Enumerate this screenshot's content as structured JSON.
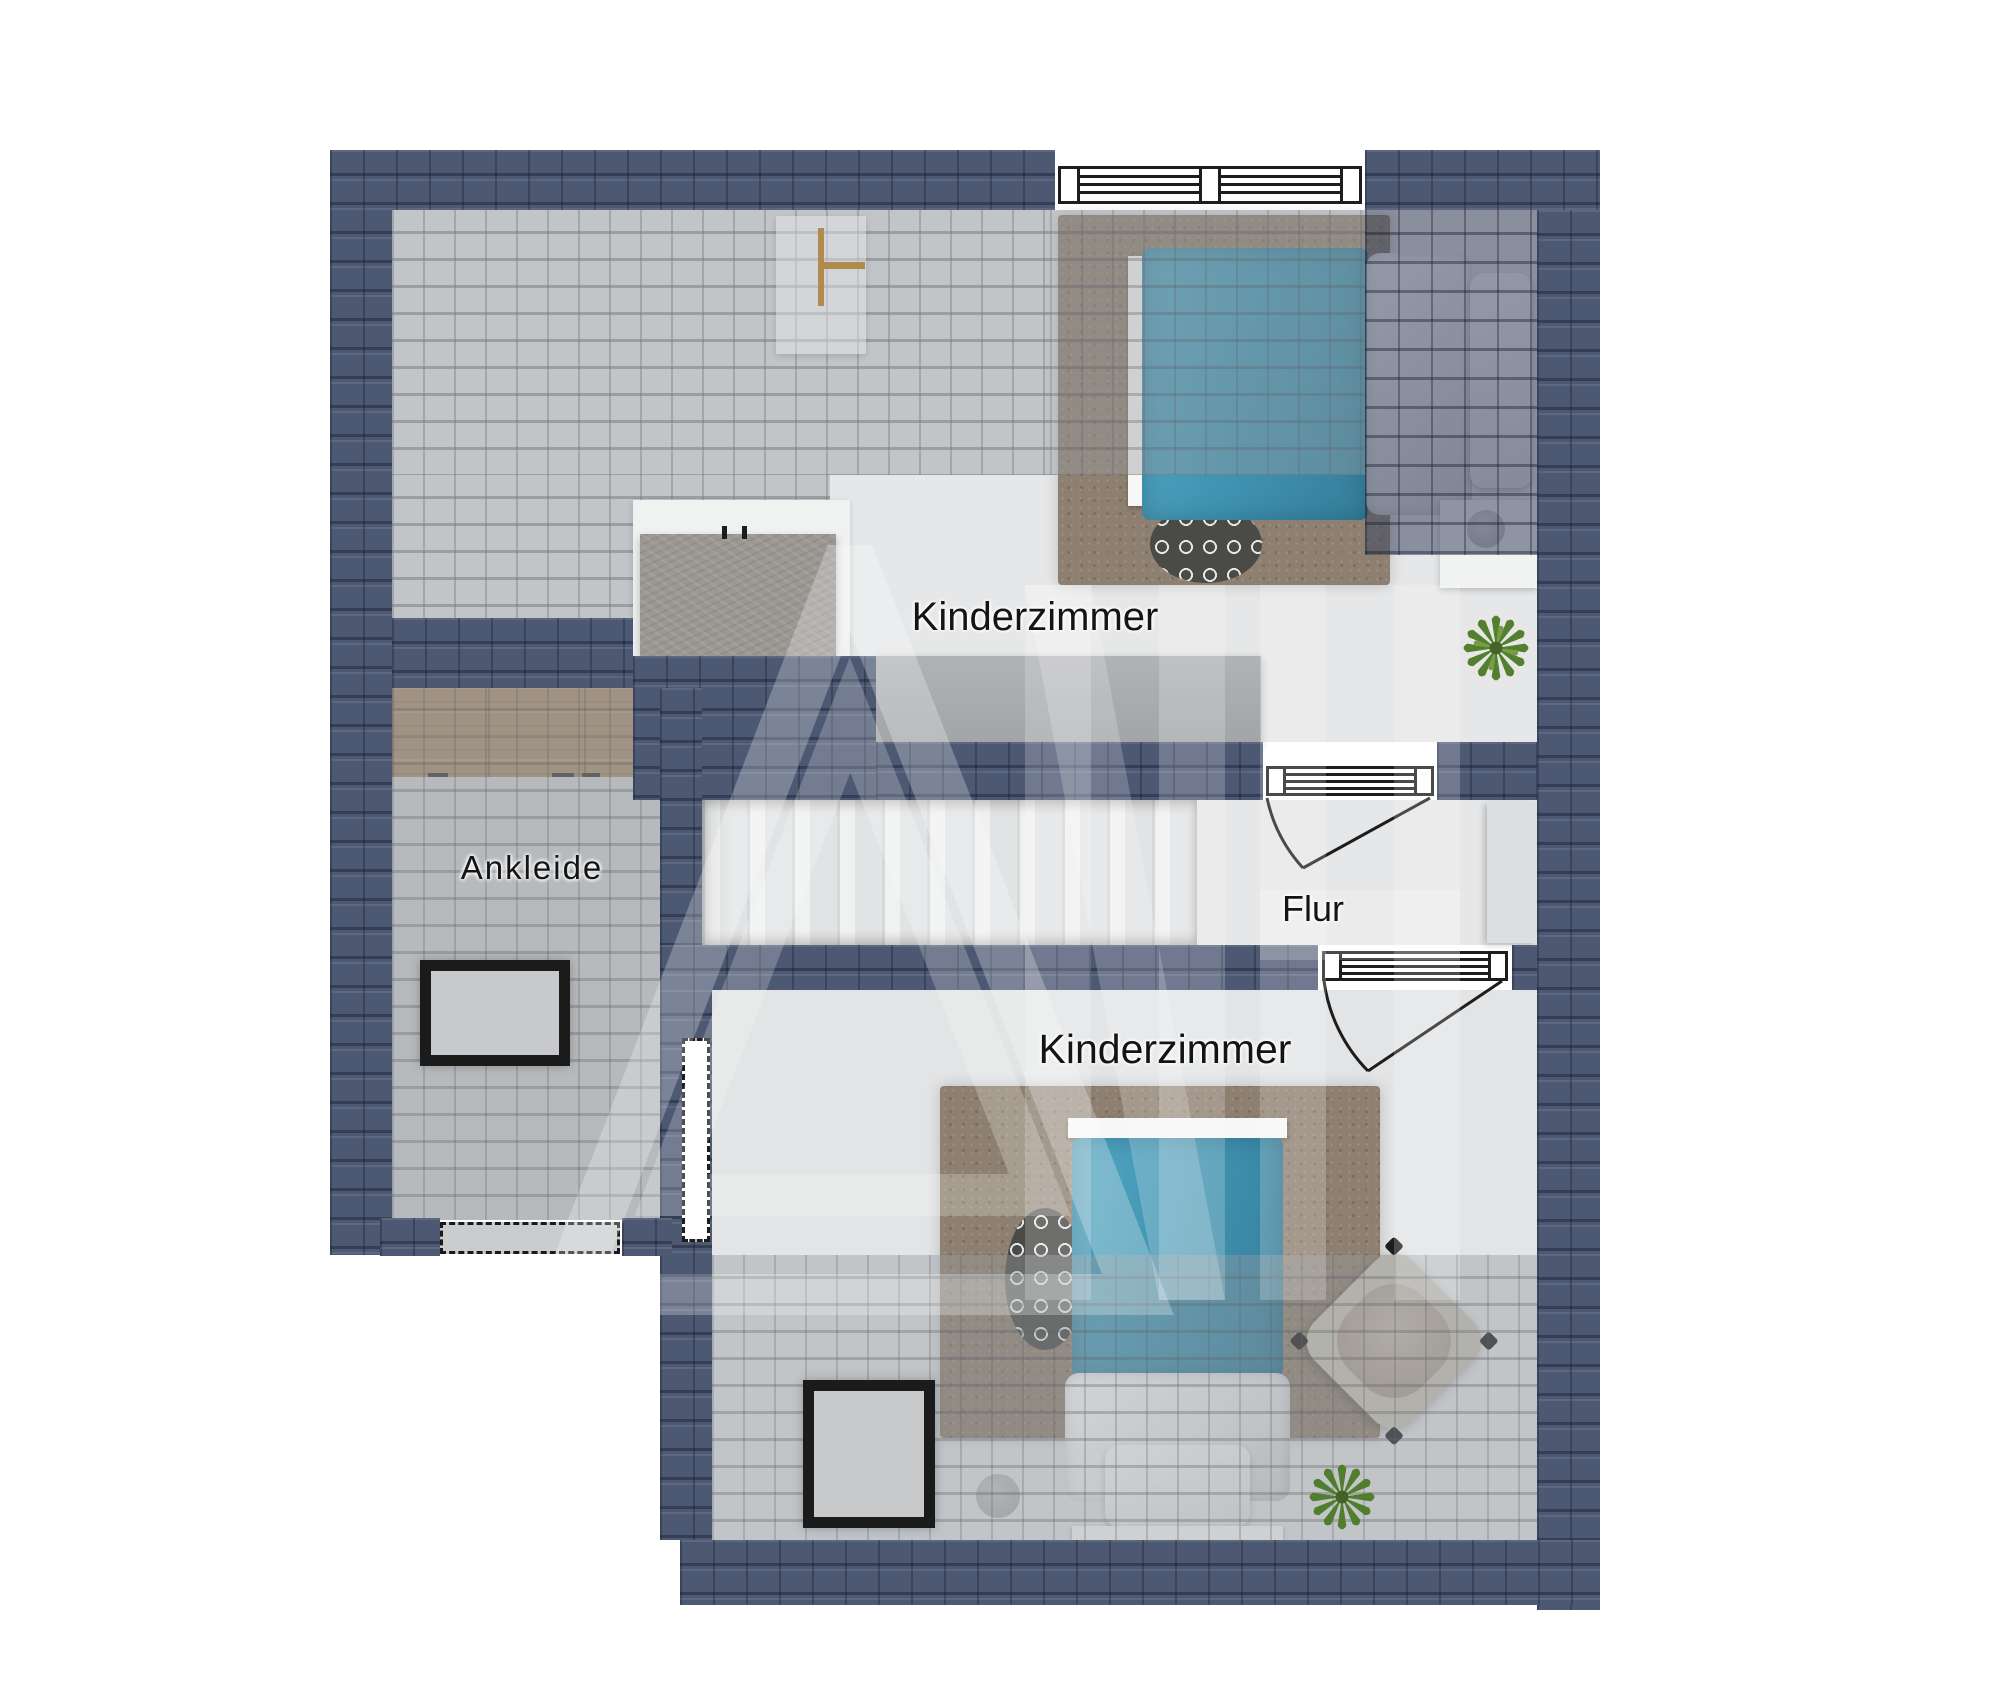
{
  "rooms": [
    {
      "id": "kinderzimmer-top",
      "label": "Kinderzimmer"
    },
    {
      "id": "ankleide",
      "label": "Ankleide"
    },
    {
      "id": "flur",
      "label": "Flur"
    },
    {
      "id": "kinderzimmer-bottom",
      "label": "Kinderzimmer"
    }
  ],
  "colors": {
    "roof_slate": "#4d5873",
    "interior_tile": "#c2c5c8",
    "room_floor": "#e6e7e8",
    "wood_cabinet": "#a88d6e",
    "bed_blanket_teal": "#4195b3",
    "rug_brown": "#8e8070",
    "patterned_rug_dark": "#4a4a47",
    "plant_green": "#4c7a26"
  },
  "furniture": [
    "double-window",
    "bed-top-room",
    "bed-bottom-room",
    "shag-rug-top",
    "shag-rug-bottom",
    "patterned-rug-top",
    "patterned-rug-bottom",
    "nightstand",
    "table-lamp",
    "potted-plant-top",
    "potted-plant-bottom",
    "wardrobe",
    "wood-dresser",
    "staircase",
    "swing-door-flur",
    "swing-door-kinderzimmer",
    "roof-window-ankleide",
    "roof-window-kinderzimmer",
    "dormer-window",
    "side-window",
    "butterfly-chair",
    "stool",
    "desk",
    "chimney-block",
    "hall-shelf"
  ],
  "watermark": {
    "name": "house-logo-watermark"
  }
}
